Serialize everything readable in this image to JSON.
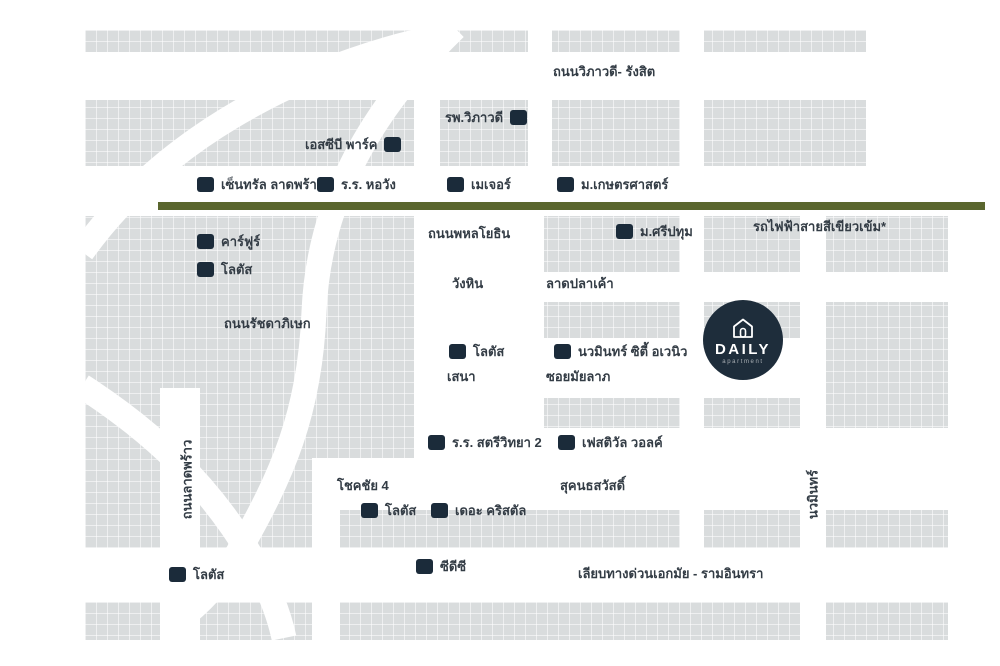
{
  "road_labels": {
    "vibhavadi": "ถนนวิภาวดี- รังสิต",
    "phahonyothin": "ถนนพหลโยธิน",
    "wanghin": "วังหิน",
    "latplakao": "ลาดปลาเค้า",
    "ratchadaphisek": "ถนนรัชดาภิเษก",
    "sena": "เสนา",
    "mayalap": "ซอยมัยลาภ",
    "chokchai4": "โชคชัย 4",
    "sukhonthasawat": "สุคนธสวัสดิ์",
    "expressway": "เลียบทางด่วนเอกมัย - รามอินทรา",
    "ladprao": "ถนนลาดพร้าว",
    "nawamin": "นวมินทร์"
  },
  "transit": {
    "label": "รถไฟฟ้าสายสีเขียวเข้ม*",
    "color": "#5a662e"
  },
  "poi": [
    {
      "id": "central-ladprao",
      "label": "เซ็นทรัล ลาดพร้าว"
    },
    {
      "id": "horwang-school",
      "label": "ร.ร. หอวัง"
    },
    {
      "id": "major",
      "label": "เมเจอร์"
    },
    {
      "id": "kasetsart-university",
      "label": "ม.เกษตรศาสตร์"
    },
    {
      "id": "sripatum-university",
      "label": "ม.ศรีปทุม"
    },
    {
      "id": "carrefour",
      "label": "คาร์ฟูร์"
    },
    {
      "id": "lotus-ladprao",
      "label": "โลตัส"
    },
    {
      "id": "lotus-wanghin",
      "label": "โลตัส"
    },
    {
      "id": "nawamin-city-avenue",
      "label": "นวมินทร์ ซิตี้ อเวนิว"
    },
    {
      "id": "satriwitthaya2-school",
      "label": "ร.ร. สตรีวิทยา 2"
    },
    {
      "id": "festival-walk",
      "label": "เฟสติวัล วอลค์"
    },
    {
      "id": "lotus-chokchai",
      "label": "โลตัส"
    },
    {
      "id": "the-crystal",
      "label": "เดอะ คริสตัล"
    },
    {
      "id": "cdc",
      "label": "ซีดีซี"
    },
    {
      "id": "lotus-expressway",
      "label": "โลตัส"
    },
    {
      "id": "vibhavadi-hospital",
      "label": "รพ.วิภาวดี"
    },
    {
      "id": "scb-park",
      "label": "เอสซีบี พาร์ค"
    }
  ],
  "badge": {
    "name": "DAILY",
    "tagline": "apartment",
    "icon": "house-icon"
  },
  "colors": {
    "block": "#d9dcdd",
    "road": "#ffffff",
    "marker": "#1b2b3a",
    "text": "#333c45",
    "badge": "#1e2d3b",
    "transit_line": "#5a662e"
  }
}
